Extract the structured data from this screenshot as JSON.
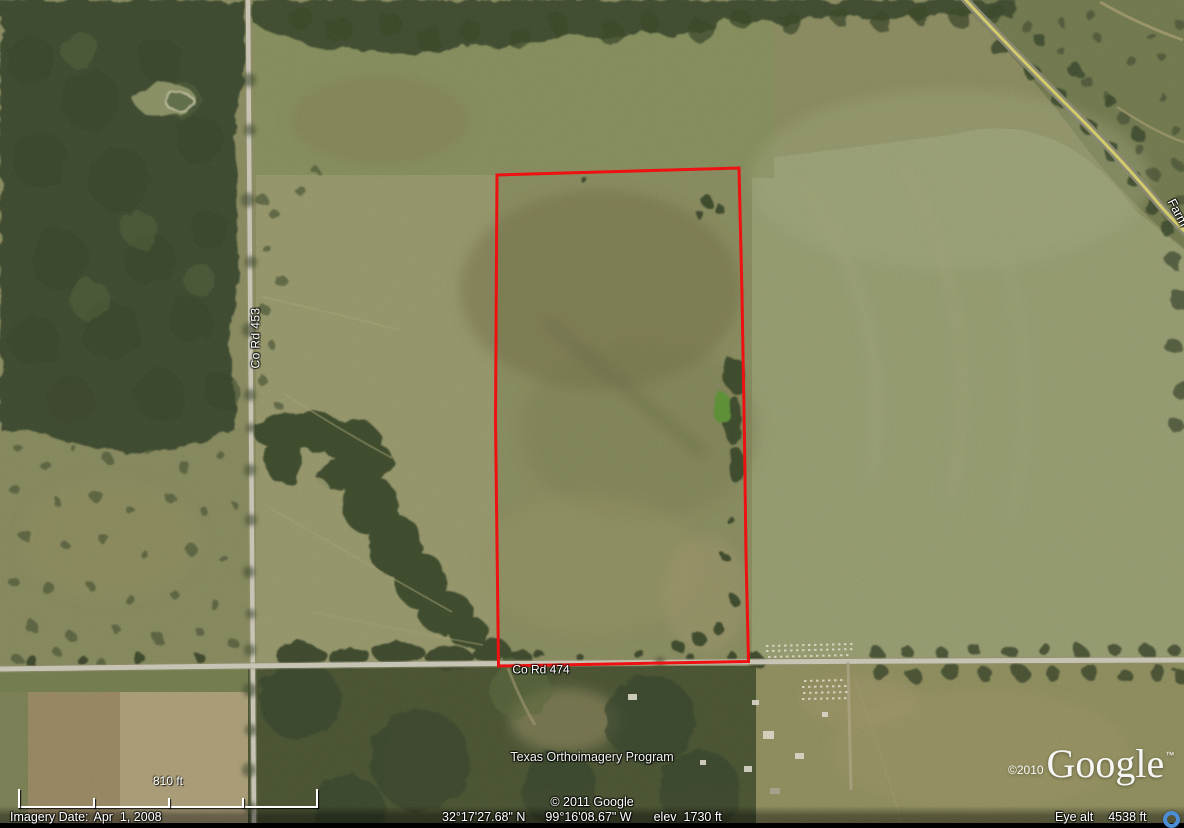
{
  "map": {
    "road_labels": {
      "vertical_road": "Co Rd 453",
      "horizontal_road": "Co Rd 474",
      "edge_road_partial": "Farm"
    },
    "imagery_overlay_credit": "Texas Orthoimagery Program",
    "map_copyright": "© 2011 Google",
    "watermark": {
      "copyright": "©2010",
      "logo_text": "Google",
      "trademark": "™"
    }
  },
  "scale_bar": {
    "label": "810 ft"
  },
  "status_bar": {
    "imagery_date_label": "Imagery Date:",
    "imagery_date_value": "Apr  1, 2008",
    "latitude": "32°17'27.68\" N",
    "longitude": "99°16'08.67\" W",
    "elevation_label": "elev",
    "elevation_value": "1730 ft",
    "eye_altitude_label": "Eye alt",
    "eye_altitude_value": "4538 ft"
  },
  "colors": {
    "boundary_red": "#ee1111",
    "farm_road_yellow": "#ded76e",
    "road_gray": "#d2cfbf",
    "field_olive": "#8f9062",
    "forest_green": "#3e4c2d",
    "streaming_indicator_blue": "#4b8ed6",
    "label_text": "#ffffff"
  }
}
